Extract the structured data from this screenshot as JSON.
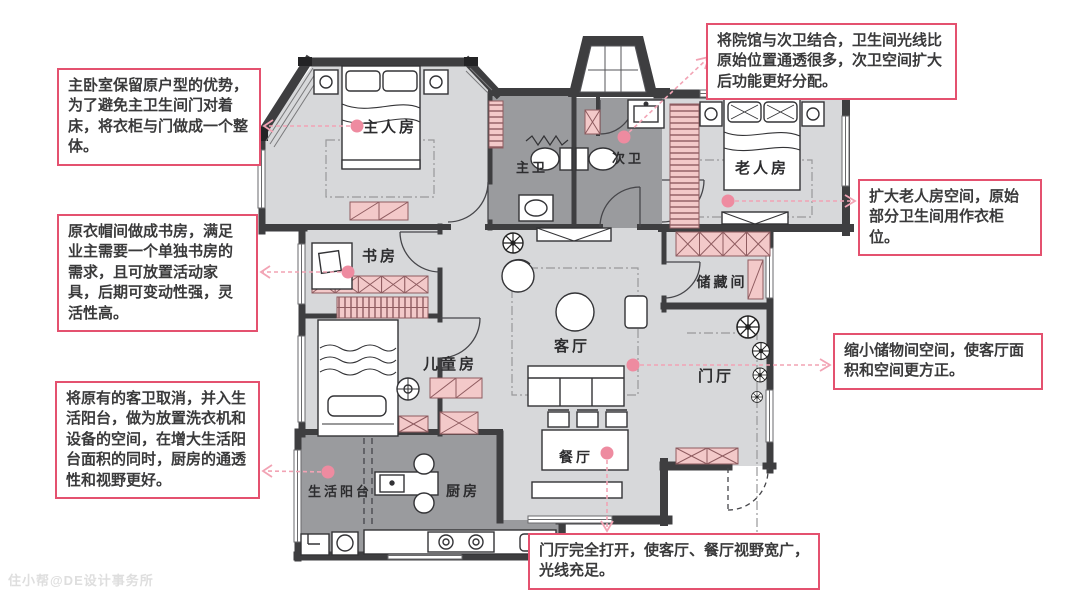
{
  "plan": {
    "rooms": [
      {
        "id": "master-bedroom",
        "label": "主人房"
      },
      {
        "id": "master-bath",
        "label": "主卫"
      },
      {
        "id": "second-bath",
        "label": "次卫"
      },
      {
        "id": "elder-room",
        "label": "老人房"
      },
      {
        "id": "study",
        "label": "书房"
      },
      {
        "id": "storage-room",
        "label": "储藏间"
      },
      {
        "id": "living-room",
        "label": "客厅"
      },
      {
        "id": "foyer",
        "label": "门厅"
      },
      {
        "id": "kids-room",
        "label": "儿童房"
      },
      {
        "id": "life-balcony",
        "label": "生活阳台"
      },
      {
        "id": "kitchen",
        "label": "厨房"
      },
      {
        "id": "dining-room",
        "label": "餐厅"
      }
    ]
  },
  "annotations": [
    {
      "id": "master",
      "text": "主卧室保留原户型的优势，为了避免主卫生间门对着床，将衣柜与门做成一个整体。"
    },
    {
      "id": "study",
      "text": "原衣帽间做成书房，满足业主需要一个单独书房的需求，且可放置活动家具，后期可变动性强，灵活性高。"
    },
    {
      "id": "balcony",
      "text": "将原有的客卫取消，并入生活阳台，做为放置洗衣机和设备的空间，在增大生活阳台面积的同时，厨房的通透性和视野更好。"
    },
    {
      "id": "second-bath",
      "text": "将院馆与次卫结合，卫生间光线比原始位置通透很多，次卫空间扩大后功能更好分配。"
    },
    {
      "id": "elder",
      "text": "扩大老人房空间，原始部分卫生间用作衣柜位。"
    },
    {
      "id": "storage",
      "text": "缩小储物间空间，使客厅面积和空间更方正。"
    },
    {
      "id": "foyer",
      "text": "门厅完全打开，使客厅、餐厅视野宽广，光线充足。"
    }
  ],
  "watermark": "住小帮@DE设计事务所",
  "colors": {
    "annotation_border": "#e4516f",
    "leader_pink": "#f2a3b4",
    "leader_dot": "#ee8ba0",
    "wall": "#3e3e40",
    "room_light": "#d7d8da",
    "room_dark": "#9a9b9e",
    "cabinet_pink": "#f3c9c9"
  }
}
